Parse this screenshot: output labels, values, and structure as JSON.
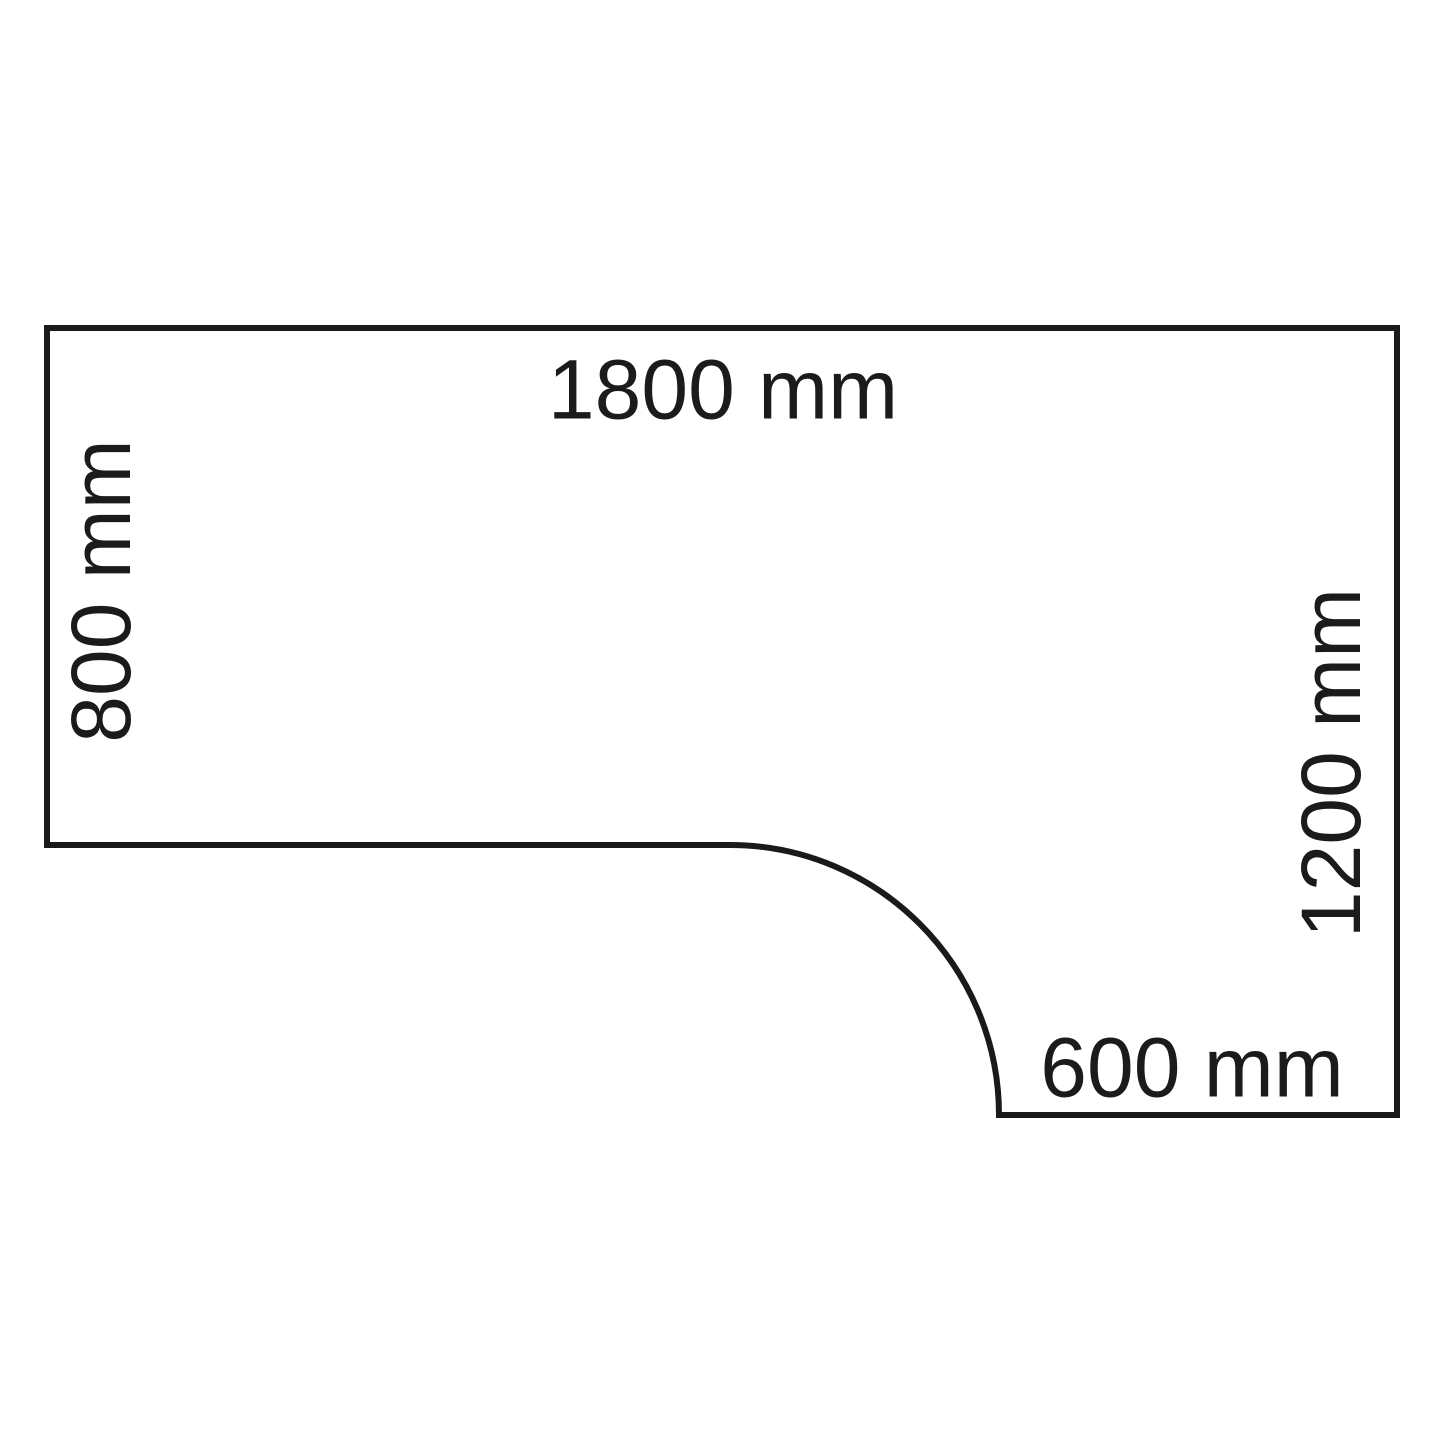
{
  "diagram": {
    "type": "dimension-diagram",
    "subject": "corner-desk-top-view",
    "background": "#ffffff",
    "line_color": "#1b1a18",
    "text_color": "#1d1b1a",
    "outline_path": "M 47 328 L 1397 328 L 1397 1115 L 999 1115 C 999 966 878 845 730 845 L 47 845 Z",
    "labels": {
      "top_width": "1800 mm",
      "left_depth": "800 mm",
      "right_depth": "1200 mm",
      "bottom_width": "600 mm"
    }
  }
}
